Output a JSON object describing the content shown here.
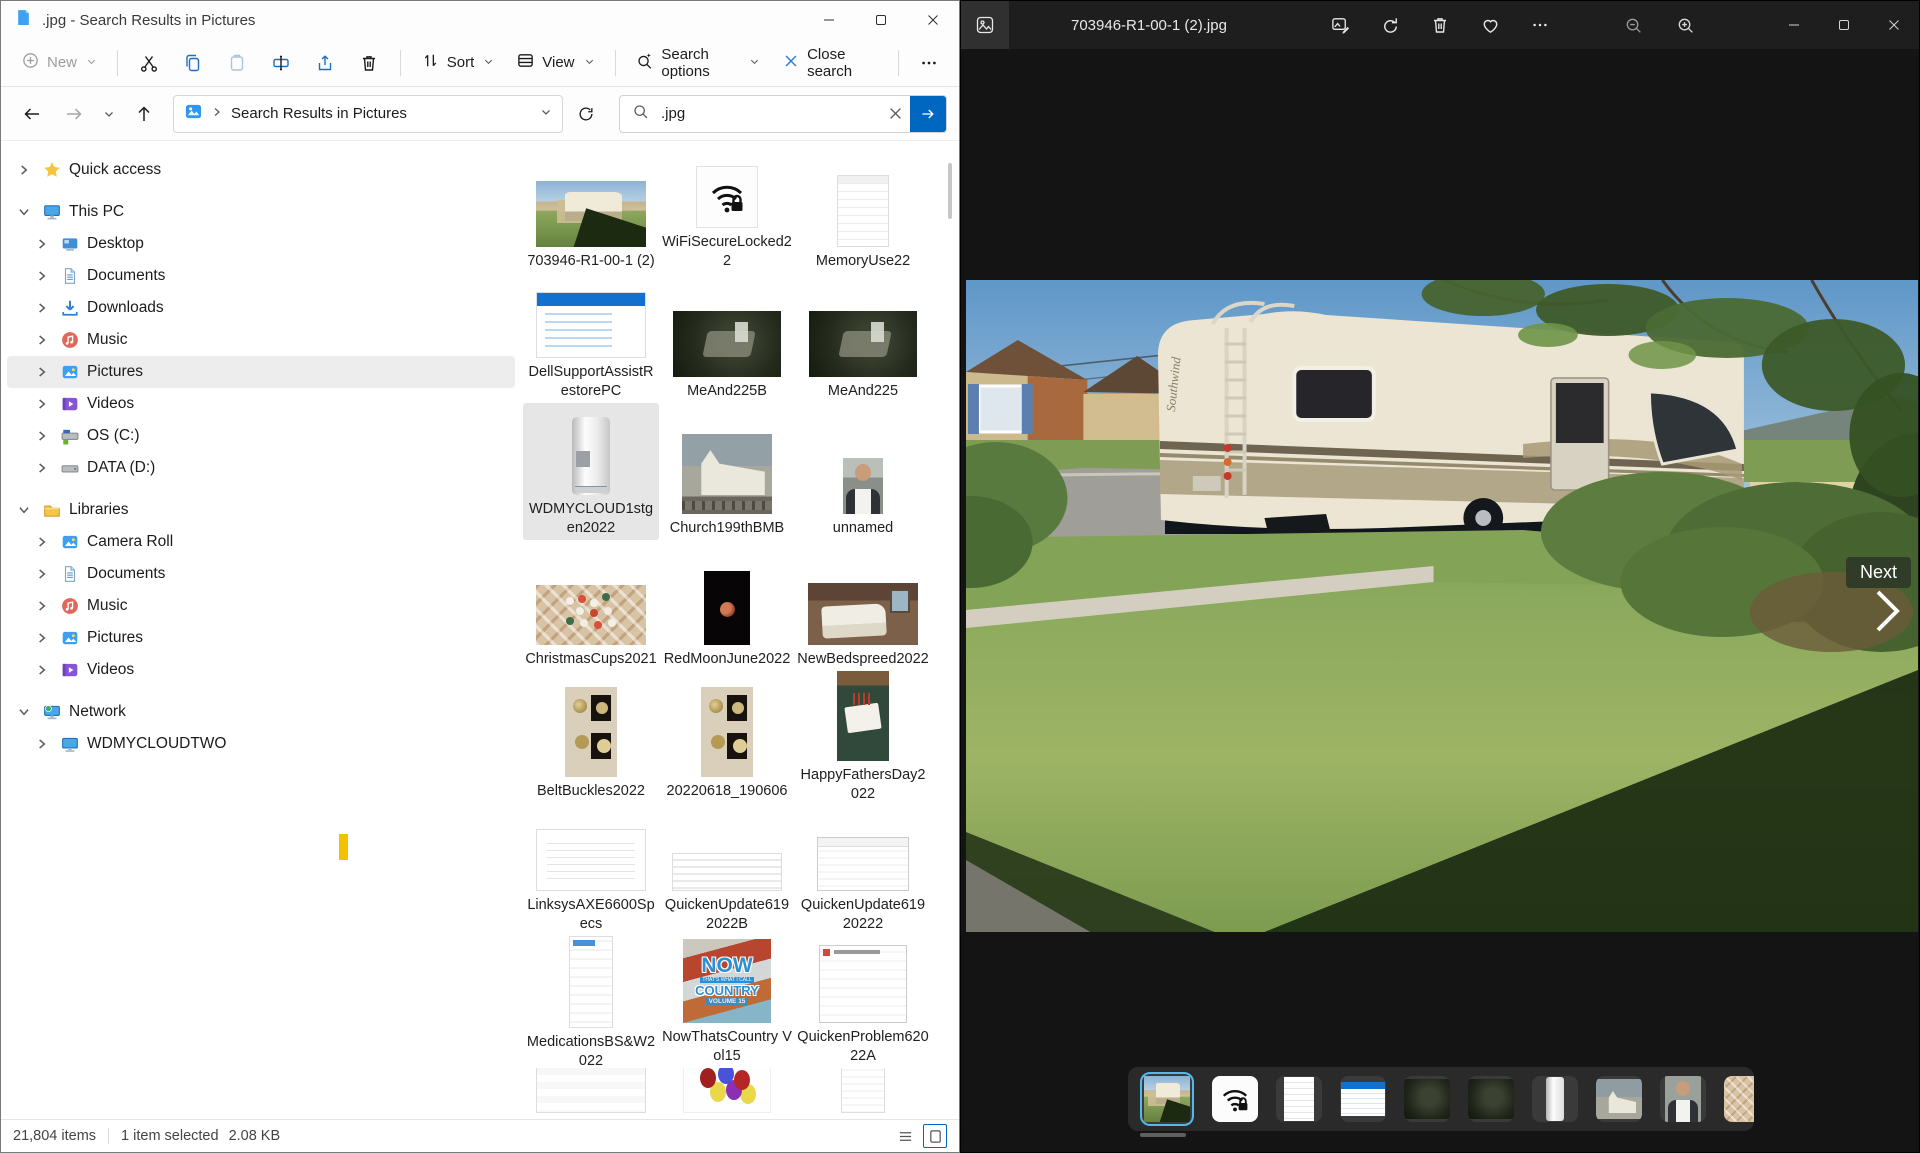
{
  "colors": {
    "accent": "#0067c0",
    "strip_selection": "#53b9ec",
    "caret_yellow": "#f2c100",
    "photos_bg": "#141414"
  },
  "explorer": {
    "title": ".jpg - Search Results in Pictures",
    "toolbar": {
      "new_label": "New",
      "sort_label": "Sort",
      "view_label": "View",
      "search_options_label": "Search options",
      "close_search_label": "Close search"
    },
    "navbar": {
      "breadcrumb_root": "Search Results in Pictures",
      "search_value": ".jpg"
    },
    "sidebar": {
      "items": [
        {
          "label": "Quick access",
          "icon": "star",
          "level": 0,
          "expanded": false,
          "gap": false
        },
        {
          "label": "This PC",
          "icon": "pc",
          "level": 0,
          "expanded": true,
          "gap": true
        },
        {
          "label": "Desktop",
          "icon": "desktop",
          "level": 1,
          "expanded": false
        },
        {
          "label": "Documents",
          "icon": "documents",
          "level": 1,
          "expanded": false
        },
        {
          "label": "Downloads",
          "icon": "downloads",
          "level": 1,
          "expanded": false
        },
        {
          "label": "Music",
          "icon": "music",
          "level": 1,
          "expanded": false
        },
        {
          "label": "Pictures",
          "icon": "pictures",
          "level": 1,
          "expanded": false,
          "selected": true
        },
        {
          "label": "Videos",
          "icon": "videos",
          "level": 1,
          "expanded": false
        },
        {
          "label": "OS (C:)",
          "icon": "driveos",
          "level": 1,
          "expanded": false
        },
        {
          "label": "DATA (D:)",
          "icon": "drive",
          "level": 1,
          "expanded": false
        },
        {
          "label": "Libraries",
          "icon": "libraries",
          "level": 0,
          "expanded": true,
          "gap": true
        },
        {
          "label": "Camera Roll",
          "icon": "pictures",
          "level": 1,
          "expanded": false
        },
        {
          "label": "Documents",
          "icon": "documents",
          "level": 1,
          "expanded": false
        },
        {
          "label": "Music",
          "icon": "music",
          "level": 1,
          "expanded": false
        },
        {
          "label": "Pictures",
          "icon": "pictures",
          "level": 1,
          "expanded": false
        },
        {
          "label": "Videos",
          "icon": "videos",
          "level": 1,
          "expanded": false
        },
        {
          "label": "Network",
          "icon": "network",
          "level": 0,
          "expanded": true,
          "gap": true
        },
        {
          "label": "WDMYCLOUDTWO",
          "icon": "netpc",
          "level": 1,
          "expanded": false
        }
      ]
    },
    "files": [
      {
        "name": "703946-R1-00-1 (2)",
        "kind": "rv"
      },
      {
        "name": "WiFiSecureLocked22",
        "kind": "wifi"
      },
      {
        "name": "MemoryUse22",
        "kind": "doc"
      },
      {
        "name": "DellSupportAssistRestorePC",
        "kind": "dell"
      },
      {
        "name": "MeAnd225B",
        "kind": "dark"
      },
      {
        "name": "MeAnd225",
        "kind": "dark"
      },
      {
        "name": "WDMYCLOUD1stgen2022",
        "kind": "wd",
        "selected": true
      },
      {
        "name": "Church199thBMB",
        "kind": "church"
      },
      {
        "name": "unnamed",
        "kind": "man"
      },
      {
        "name": "ChristmasCups2021",
        "kind": "cups"
      },
      {
        "name": "RedMoonJune2022",
        "kind": "moon"
      },
      {
        "name": "NewBedspreed2022",
        "kind": "bed"
      },
      {
        "name": "BeltBuckles2022",
        "kind": "buckles"
      },
      {
        "name": "20220618_190606",
        "kind": "buckles"
      },
      {
        "name": "HappyFathersDay2022",
        "kind": "fathers"
      },
      {
        "name": "LinksysAXE6600Specs",
        "kind": "linksys"
      },
      {
        "name": "QuickenUpdate6192022B",
        "kind": "qrows"
      },
      {
        "name": "QuickenUpdate61920222",
        "kind": "qdlg"
      },
      {
        "name": "MedicationsBS&W2022",
        "kind": "meds"
      },
      {
        "name": "NowThatsCountry Vol15",
        "kind": "now"
      },
      {
        "name": "QuickenProblem62022A",
        "kind": "qprob"
      },
      {
        "name": "",
        "kind": "dates"
      },
      {
        "name": "",
        "kind": "balloons"
      },
      {
        "name": "",
        "kind": "receipt"
      }
    ],
    "status": {
      "items_count": "21,804 items",
      "selection": "1 item selected",
      "selection_size": "2.08 KB"
    }
  },
  "photos": {
    "filename": "703946-R1-00-1 (2).jpg",
    "next_tooltip": "Next",
    "album_art": {
      "line1": "NOW",
      "line2": "THAT'S WHAT I CALL",
      "line3": "COUNTRY",
      "line4": "VOLUME 15"
    },
    "filmstrip": {
      "thumbs": [
        {
          "kind": "rv",
          "selected": true
        },
        {
          "kind": "wifi"
        },
        {
          "kind": "doc"
        },
        {
          "kind": "dell"
        },
        {
          "kind": "dark"
        },
        {
          "kind": "dark"
        },
        {
          "kind": "wd"
        },
        {
          "kind": "church"
        },
        {
          "kind": "man"
        },
        {
          "kind": "cups"
        }
      ]
    }
  }
}
